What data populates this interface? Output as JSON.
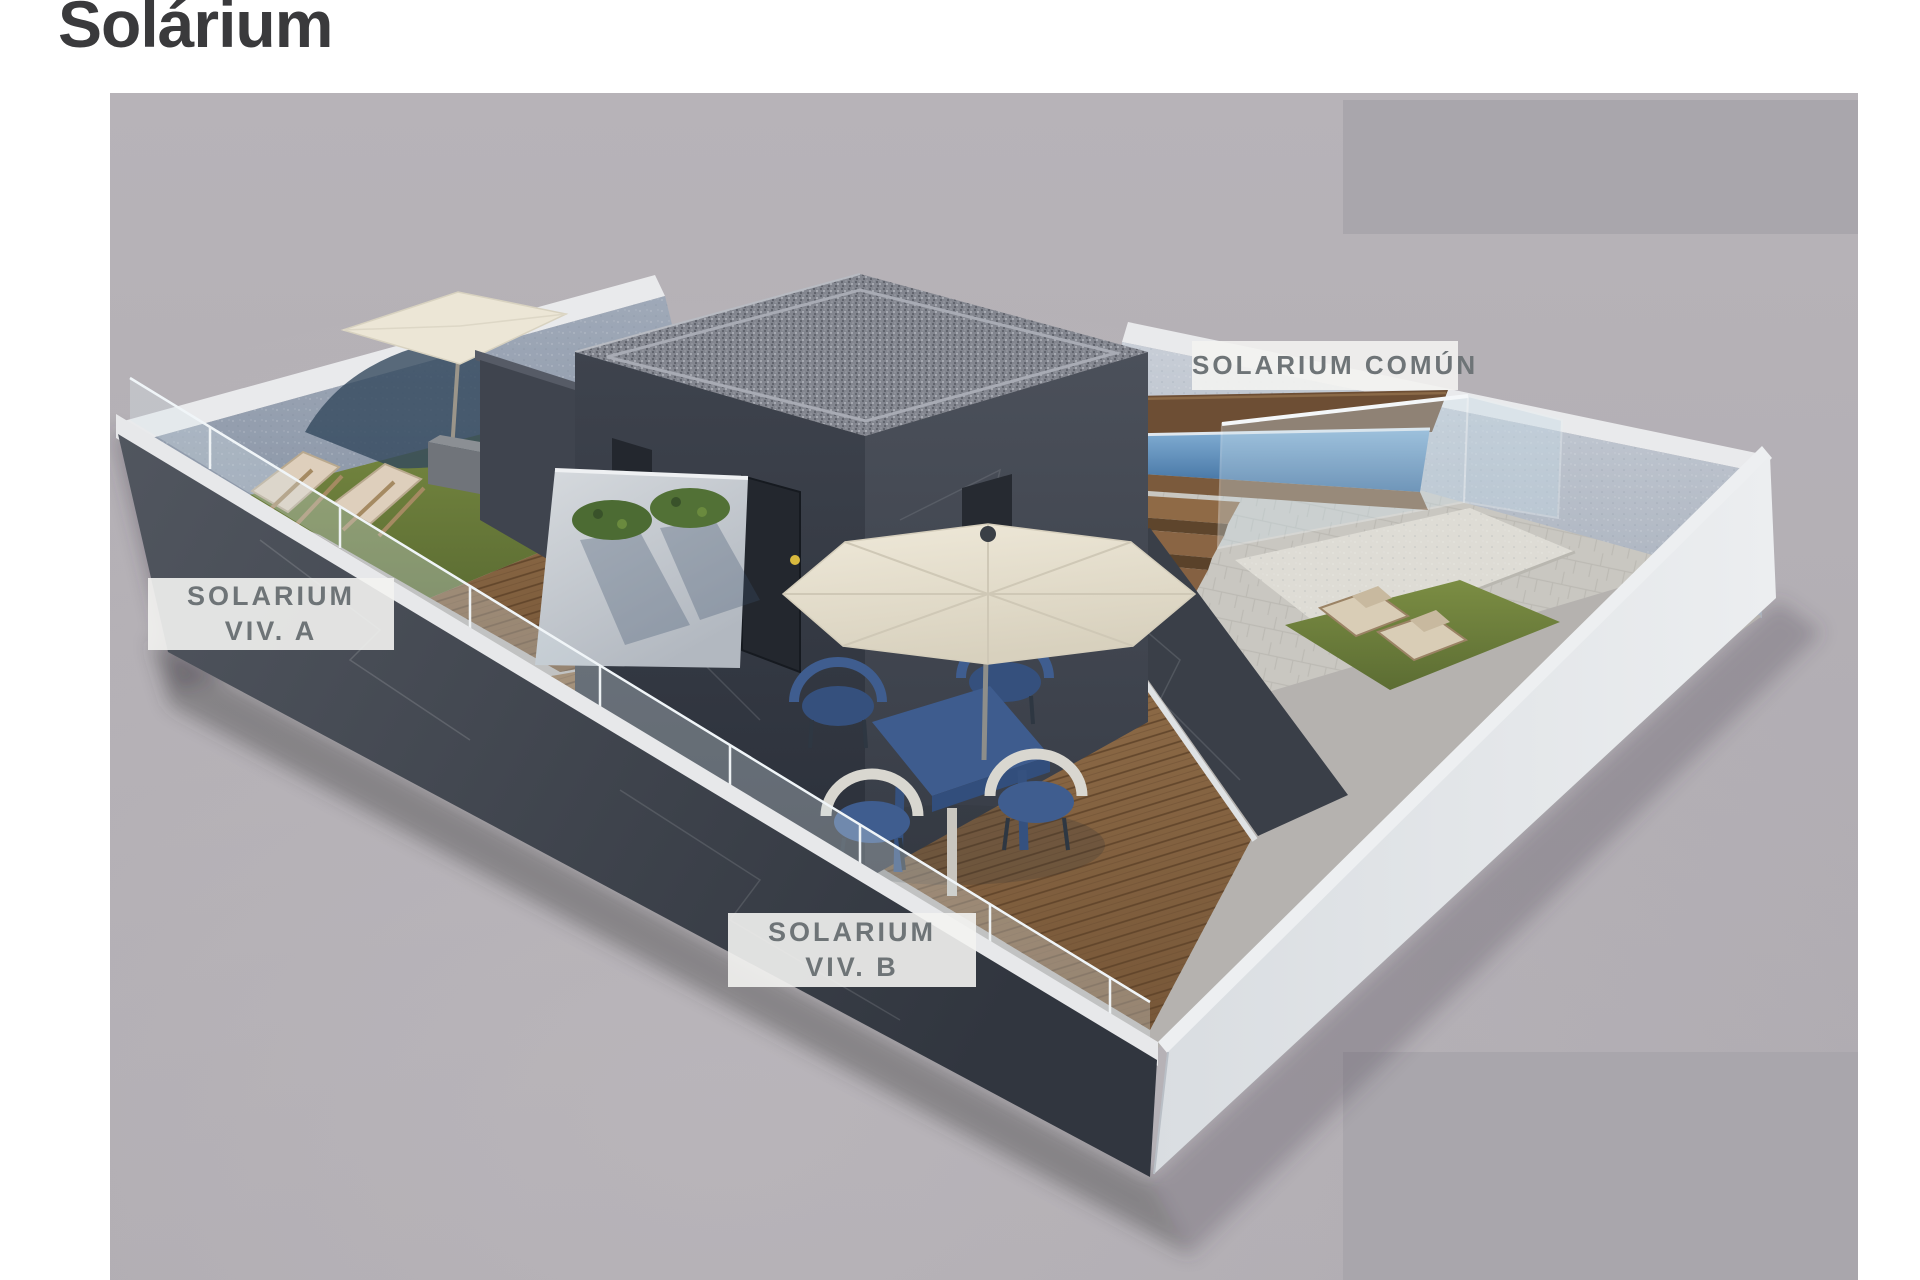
{
  "page": {
    "title": "Solárium"
  },
  "render": {
    "description": "3D aerial rendering of rooftop solarium terraces of a duplex villa",
    "labels": {
      "viv_a": {
        "line1": "SOLARIUM",
        "line2": "VIV. A"
      },
      "viv_b": {
        "line1": "SOLARIUM",
        "line2": "VIV. B"
      },
      "comun": {
        "line1": "SOLARIUM COMÚN"
      }
    }
  },
  "colors": {
    "title-text": "#3a3a3c",
    "label-bg": "#f3f3f1",
    "label-text": "#6e7477",
    "ground": "#b2aeb3",
    "redaction": "#a9a6ac",
    "wall-dark": "#3c414b",
    "wall-light": "#e0e3e7",
    "wall-back": "#9aa3b2",
    "grass": "#6f7f41",
    "wood-deck": "#8a6544",
    "pool-water": "#4f7fae",
    "umbrella": "#e8e2d2",
    "furniture-blue": "#3e5c8e"
  }
}
